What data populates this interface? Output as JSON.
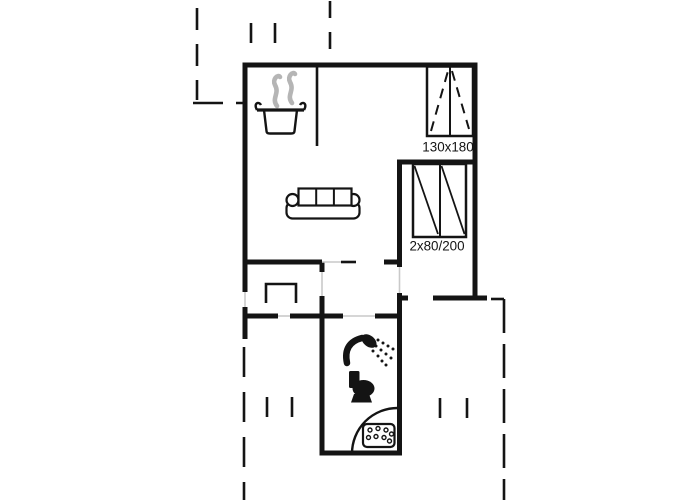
{
  "plan": {
    "kind": "floor-plan",
    "labels": {
      "double_bed_size": "130x180",
      "bunk_beds_size": "2x80/200"
    },
    "colors": {
      "wall": "#141414",
      "door_opening": "#c9c9c9",
      "steam": "#b5b5b5",
      "background": "#ffffff"
    },
    "icons": [
      {
        "name": "cooking-pot-steam-icon"
      },
      {
        "name": "sofa-icon"
      },
      {
        "name": "double-bed-icon"
      },
      {
        "name": "bunk-beds-icon"
      },
      {
        "name": "shower-icon"
      },
      {
        "name": "toilet-icon"
      },
      {
        "name": "corner-shower-tray-icon"
      },
      {
        "name": "drain-grate-icon"
      }
    ]
  }
}
